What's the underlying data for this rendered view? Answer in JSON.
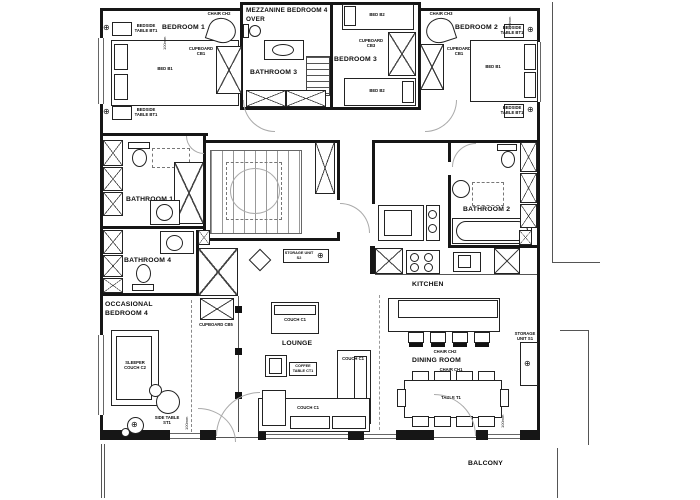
{
  "plan": {
    "rooms": {
      "bedroom1": "BEDROOM 1",
      "bedroom2": "BEDROOM 2",
      "bedroom3": "BEDROOM 3",
      "mezzanine_line1": "MEZZANINE BEDROOM 4",
      "mezzanine_line2": "OVER",
      "bathroom1": "BATHROOM 1",
      "bathroom2": "BATHROOM 2",
      "bathroom3": "BATHROOM 3",
      "bathroom4": "BATHROOM 4",
      "occasional_line1": "OCCASIONAL",
      "occasional_line2": "BEDROOM 4",
      "kitchen": "KITCHEN",
      "lounge": "LOUNGE",
      "dining_room": "DINING ROOM",
      "balcony": "BALCONY"
    },
    "furniture": {
      "bed_b1": "BED B1",
      "bed_b2": "BED B2",
      "bedside_table": "BEDSIDE TABLE BT1",
      "chair_ch1": "CHAIR CH1",
      "chair_ch2": "CHAIR CH2",
      "chair_ch3": "CHAIR CH3",
      "cupboard_cb1": "CUPBOARD CB1",
      "cupboard_cb3": "CUPBOARD CB3",
      "cupboard_cb5": "CUPBOARD CB5",
      "couch_c1": "COUCH C1",
      "sleeper_couch_c2": "SLEEPER COUCH C2",
      "coffee_table_ct1": "COFFEE TABLE CT1",
      "side_table_st1": "SIDE TABLE ST1",
      "table_t1": "TABLE T1",
      "storage_unit_s1": "STORAGE UNIT S1",
      "storage_unit_s2": "STORAGE UNIT S2"
    },
    "annotations": {
      "level_note": "100mm"
    },
    "icons": {
      "fixture_symbol": "⊕"
    }
  }
}
